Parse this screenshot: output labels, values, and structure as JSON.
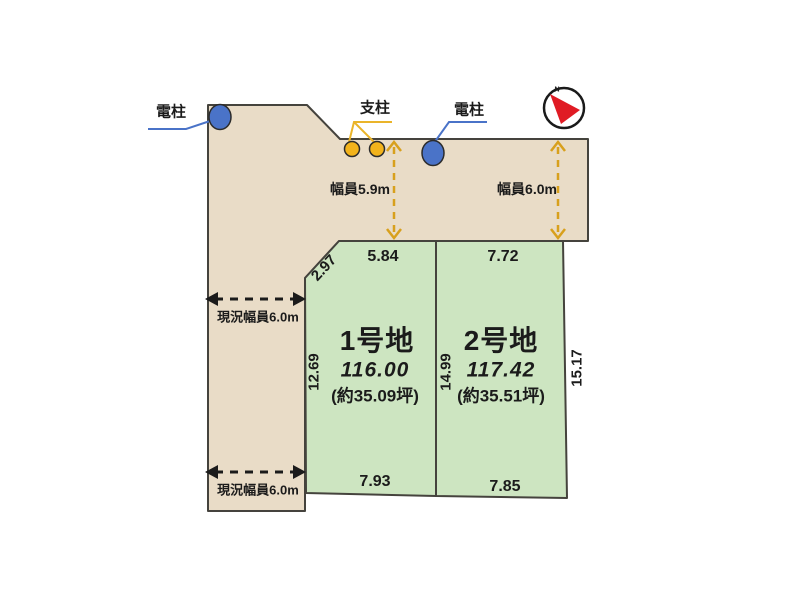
{
  "annotations": {
    "pole_left": "電柱",
    "support": "支柱",
    "pole_right": "電柱",
    "road_width_main": "幅員5.9m",
    "road_width_east": "幅員6.0m",
    "current_width_upper": "現況幅員6.0m",
    "current_width_lower": "現況幅員6.0m",
    "north_mark": "N"
  },
  "plots": [
    {
      "name": "1号地",
      "area_sqm": "116.00",
      "area_tsubo": "(約35.09坪)",
      "dims": {
        "top": "5.84",
        "chamfer": "2.97",
        "left": "12.69",
        "bottom": "7.93"
      }
    },
    {
      "name": "2号地",
      "area_sqm": "117.42",
      "area_tsubo": "(約35.51坪)",
      "dims": {
        "top": "7.72",
        "left": "14.99",
        "right": "15.17",
        "bottom": "7.85"
      }
    }
  ],
  "colors": {
    "road_fill": "#e9dcc7",
    "plot_fill": "#cde5c1",
    "outline": "#45433d",
    "pole_blue": "#4a73c8",
    "support_yellow": "#f2b31c",
    "dim_arrow_yellow": "#d8a01d",
    "north_red": "#e01b24"
  }
}
